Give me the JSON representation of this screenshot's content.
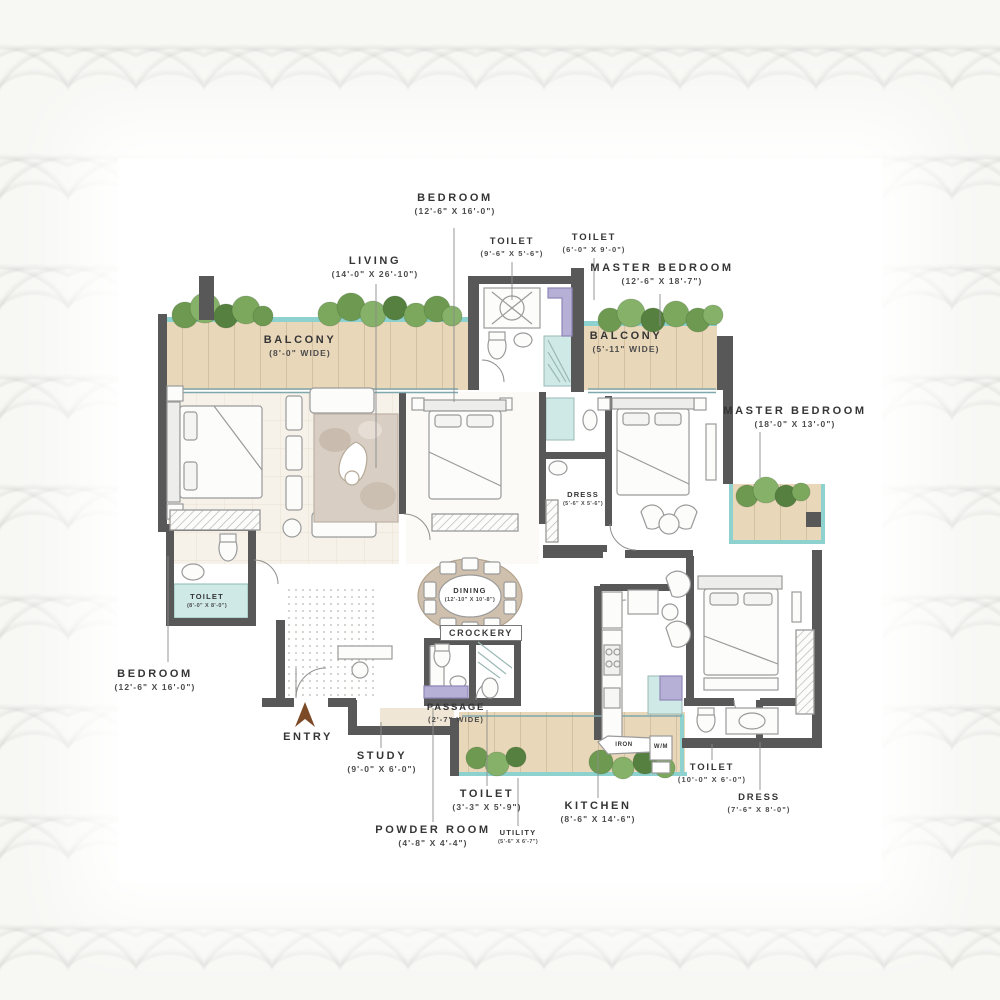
{
  "plan": {
    "type": "apartment-floor-plan",
    "colors": {
      "wall": "#585858",
      "balcony_wood": "#e9d7ba",
      "glass_teal": "#8ed2d0",
      "toilet_floor": "#cfe9e6",
      "fixture_purple": "#b6afd6",
      "plant_green": "#6d9a50",
      "label_text": "#353535",
      "entry_arrow": "#7d4a28"
    }
  },
  "labels": {
    "bedroom_top": {
      "name": "BEDROOM",
      "dims": "(12'-6\" X 16'-0\")"
    },
    "toilet_top1": {
      "name": "TOILET",
      "dims": "(9'-6\" X 5'-6\")"
    },
    "toilet_top2": {
      "name": "TOILET",
      "dims": "(6'-0\" X 9'-0\")"
    },
    "master_bedroom_top": {
      "name": "MASTER BEDROOM",
      "dims": "(12'-6\" X 18'-7\")"
    },
    "living": {
      "name": "LIVING",
      "dims": "(14'-0\" X 26'-10\")"
    },
    "balcony_left": {
      "name": "BALCONY",
      "dims": "(8'-0\" WIDE)"
    },
    "balcony_right": {
      "name": "BALCONY",
      "dims": "(5'-11\" WIDE)"
    },
    "master_bedroom_right": {
      "name": "MASTER BEDROOM",
      "dims": "(18'-0\" X 13'-0\")"
    },
    "toilet_left": {
      "name": "TOILET",
      "dims": "(8'-0\" X 8'-0\")"
    },
    "dress_mid": {
      "name": "DRESS",
      "dims": "(5'-6\" X 5'-6\")"
    },
    "bedroom_left": {
      "name": "BEDROOM",
      "dims": "(12'-6\" X 16'-0\")"
    },
    "dining": {
      "name": "DINING",
      "dims": "(12'-10\" X 10'-8\")"
    },
    "crockery": {
      "name": "CROCKERY"
    },
    "entry": {
      "name": "ENTRY"
    },
    "study": {
      "name": "STUDY",
      "dims": "(9'-0\" X 6'-0\")"
    },
    "passage": {
      "name": "PASSAGE",
      "dims": "(2'-7\" WIDE)"
    },
    "toilet_bottom": {
      "name": "TOILET",
      "dims": "(3'-3\" X 5'-9\")"
    },
    "powder_room": {
      "name": "POWDER ROOM",
      "dims": "(4'-8\" X 4'-4\")"
    },
    "utility": {
      "name": "UTILITY",
      "dims": "(5'-6\" X 6'-7\")"
    },
    "kitchen": {
      "name": "KITCHEN",
      "dims": "(8'-6\" X 14'-6\")"
    },
    "toilet_right": {
      "name": "TOILET",
      "dims": "(10'-0\" X 6'-0\")"
    },
    "dress_right": {
      "name": "DRESS",
      "dims": "(7'-6\" X 8'-0\")"
    },
    "iron": {
      "name": "IRON"
    },
    "wm": {
      "name": "W/M"
    }
  }
}
